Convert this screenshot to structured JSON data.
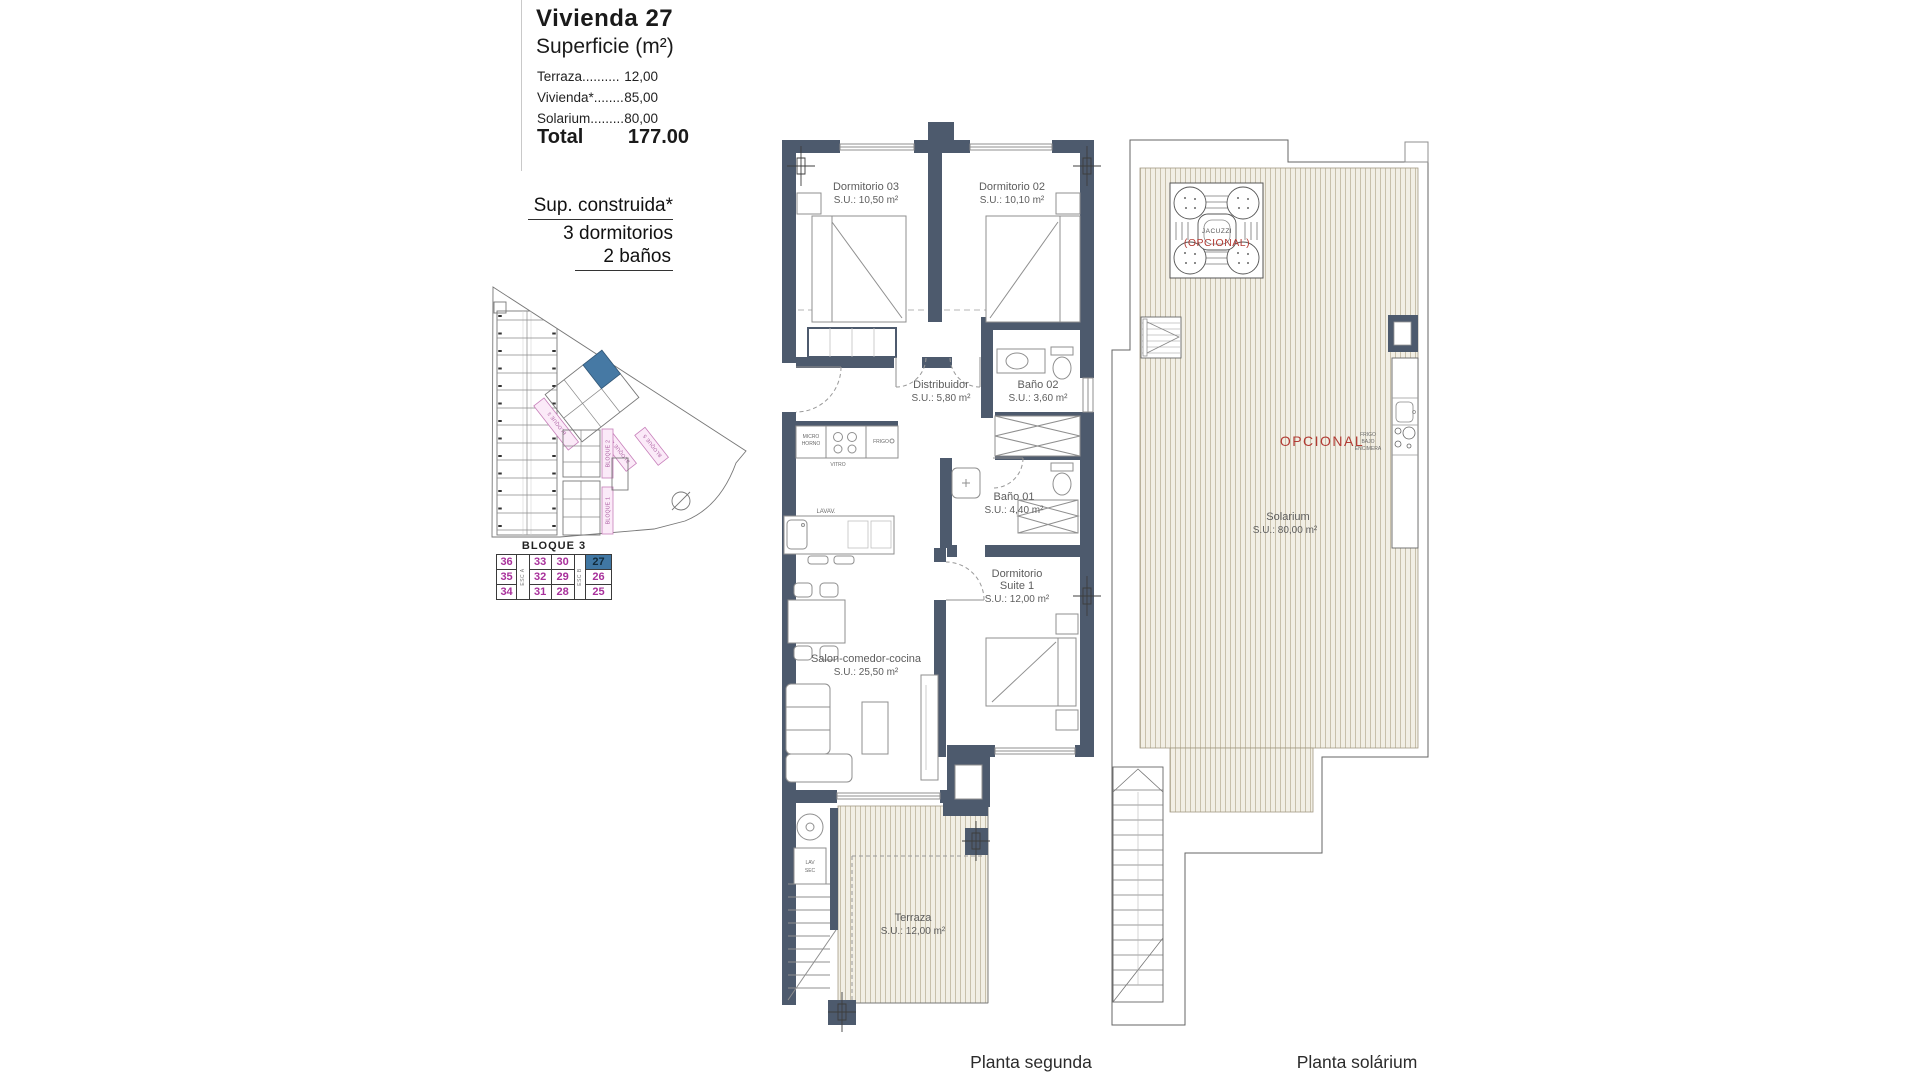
{
  "header": {
    "title": "Vivienda 27",
    "subtitle": "Superficie (m²)",
    "surface_rows": [
      {
        "label": "Terraza..........",
        "value": "12,00"
      },
      {
        "label": "Vivienda*........",
        "value": "85,00"
      },
      {
        "label": "Solarium.........",
        "value": "80,00"
      }
    ],
    "total_label": "Total",
    "total_value": "177.00",
    "built_title": "Sup. construida*",
    "built_line1": "3 dormitorios",
    "built_line2": "2 baños"
  },
  "site_plan": {
    "bloque1_label": "BLOQUE 1",
    "bloque2_label": "BLOQUE 2",
    "bloque3_label": "BLOQUE 3",
    "bloque4_label": "BLOQUE 4",
    "bloque5_label": "BLOQUE 5"
  },
  "block_table": {
    "title": "BLOQUE 3",
    "esc_a": "ESC A",
    "esc_b": "ESC B",
    "col1": [
      "36",
      "35",
      "34"
    ],
    "col2": [
      "33",
      "32",
      "31"
    ],
    "col3": [
      "30",
      "29",
      "28"
    ],
    "col4": [
      "27",
      "26",
      "25"
    ],
    "highlighted_unit": "27"
  },
  "planta_segunda": {
    "caption": "Planta segunda",
    "rooms": {
      "dorm03": {
        "name": "Dormitorio 03",
        "area": "S.U.: 10,50 m²"
      },
      "dorm02": {
        "name": "Dormitorio 02",
        "area": "S.U.: 10,10 m²"
      },
      "distribuidor": {
        "name": "Distribuidor",
        "area": "S.U.: 5,80 m²"
      },
      "bano02": {
        "name": "Baño 02",
        "area": "S.U.: 3,60 m²"
      },
      "bano01": {
        "name": "Baño 01",
        "area": "S.U.: 4,40 m²"
      },
      "suite": {
        "name_line1": "Dormitorio",
        "name_line2": "Suite 1",
        "area": "S.U.: 12,00 m²"
      },
      "salon": {
        "name": "Salon-comedor-cocina",
        "area": "S.U.: 25,50 m²"
      },
      "terraza": {
        "name": "Terraza",
        "area": "S.U.: 12,00 m²"
      }
    },
    "kitchen": {
      "micro_line1": "MICRO",
      "micro_line2": "HORNO",
      "vitro": "VITRO",
      "frigo": "FRIGO",
      "lavav": "LAVAV."
    },
    "laundry": {
      "line1": "LAV",
      "line2": "SEC"
    }
  },
  "planta_solarium": {
    "caption": "Planta solárium",
    "room": {
      "name": "Solarium",
      "area": "S.U.: 80,00 m²"
    },
    "jacuzzi": {
      "label": "JACUZZI",
      "note": "(OPCIONAL)"
    },
    "kitchen_note": "OPCIONAL",
    "frigo_line1": "FRIGO",
    "frigo_line2": "BAJO",
    "frigo_line3": "ENCIMERA"
  },
  "colors": {
    "wall": "#4d5a6d",
    "accent_blue": "#4077a3",
    "unit_number_magenta": "#a8309b",
    "optional_red": "#b23b34",
    "pink_label_bg": "#fbeaf8",
    "pink_label_border": "#c77fba",
    "deck_stripe": "#c8c0ab"
  }
}
